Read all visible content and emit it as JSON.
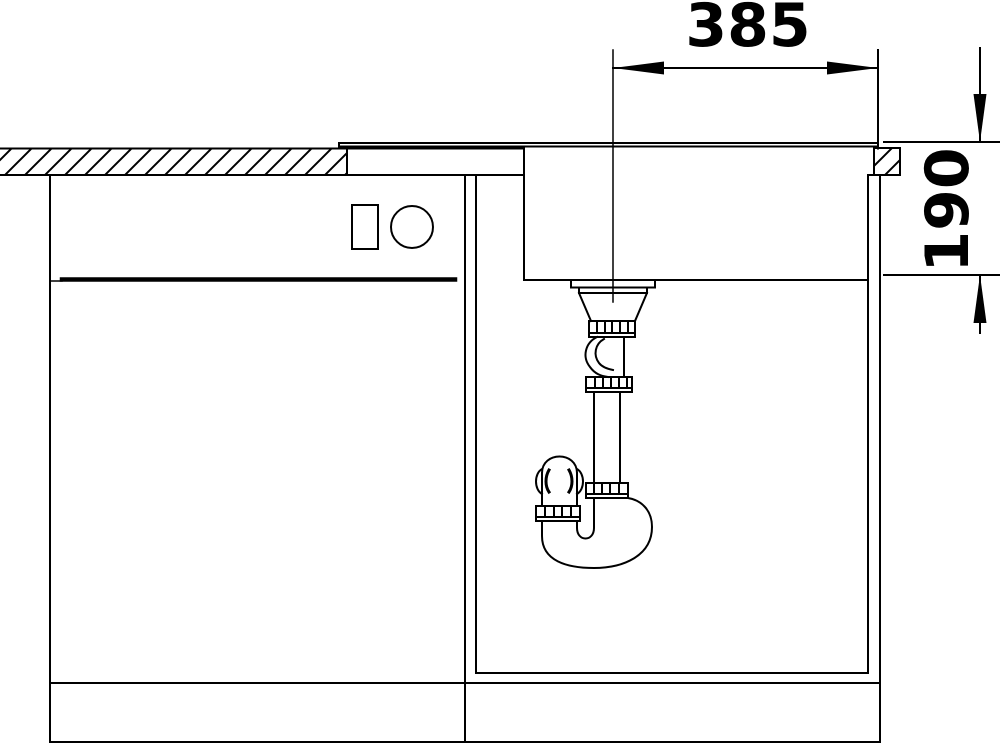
{
  "canvas": {
    "background": "#ffffff",
    "line_color": "#000000",
    "description": "technical cross-section drawing of a kitchen sink with drain trap installed in a base cabinet"
  },
  "dimensions": {
    "width": {
      "label": "385"
    },
    "depth": {
      "label": "190"
    }
  }
}
